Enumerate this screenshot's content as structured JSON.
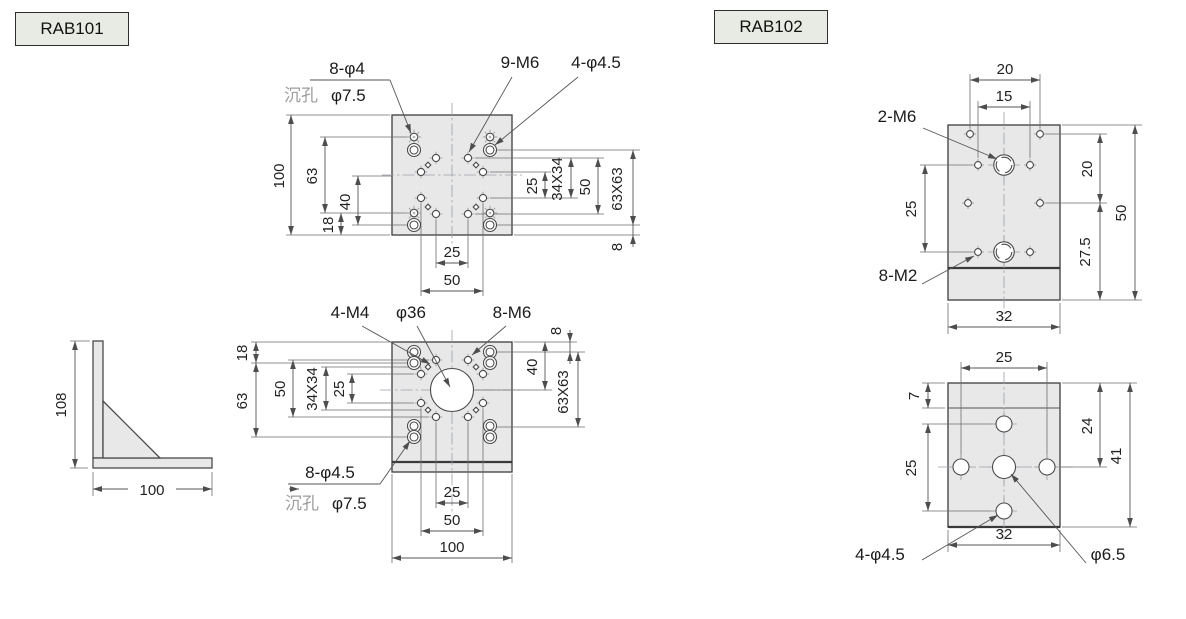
{
  "products": {
    "rab101": {
      "label": "RAB101",
      "top_view": {
        "callouts": {
          "holes_8_phi4": "8-φ4",
          "counterbore_prefix": "沉孔",
          "counterbore_value": "φ7.5",
          "holes_9_m6": "9-M6",
          "holes_4_phi45": "4-φ4.5"
        },
        "dims": {
          "d100": "100",
          "d63": "63",
          "d40": "40",
          "d18": "18",
          "d25_right": "25",
          "d34x34": "34X34",
          "d50_right": "50",
          "d63x63": "63X63",
          "d8": "8",
          "d25_bottom": "25",
          "d50_bottom": "50"
        }
      },
      "front_view": {
        "callouts": {
          "holes_4_m4": "4-M4",
          "bore_phi36": "φ36",
          "holes_8_m6": "8-M6",
          "holes_8_phi45": "8-φ4.5",
          "counterbore_prefix": "沉孔",
          "counterbore_value": "φ7.5"
        },
        "dims": {
          "d18": "18",
          "d63": "63",
          "d50": "50",
          "d34x34": "34X34",
          "d25": "25",
          "d8": "8",
          "d40": "40",
          "d63x63": "63X63",
          "d25_bottom": "25",
          "d50_bottom": "50",
          "d100": "100"
        }
      },
      "side_view": {
        "dims": {
          "d108": "108",
          "d100": "100"
        }
      }
    },
    "rab102": {
      "label": "RAB102",
      "top_view": {
        "callouts": {
          "holes_2_m6": "2-M6",
          "holes_8_m2": "8-M2"
        },
        "dims": {
          "d20_top": "20",
          "d15": "15",
          "d25_left": "25",
          "d20_right": "20",
          "d27_5": "27.5",
          "d50": "50",
          "d32": "32"
        }
      },
      "front_view": {
        "callouts": {
          "holes_4_phi45": "4-φ4.5",
          "bore_phi65": "φ6.5"
        },
        "dims": {
          "d25_top": "25",
          "d7": "7",
          "d25_left": "25",
          "d24": "24",
          "d41": "41",
          "d32": "32"
        }
      }
    }
  },
  "colors": {
    "plate_fill": "#e8e8e8",
    "outline": "#4a4a4a",
    "dimension_line": "#555555",
    "label_box_fill": "#e7ebe3",
    "counterbore_text": "#9c9c9c"
  }
}
